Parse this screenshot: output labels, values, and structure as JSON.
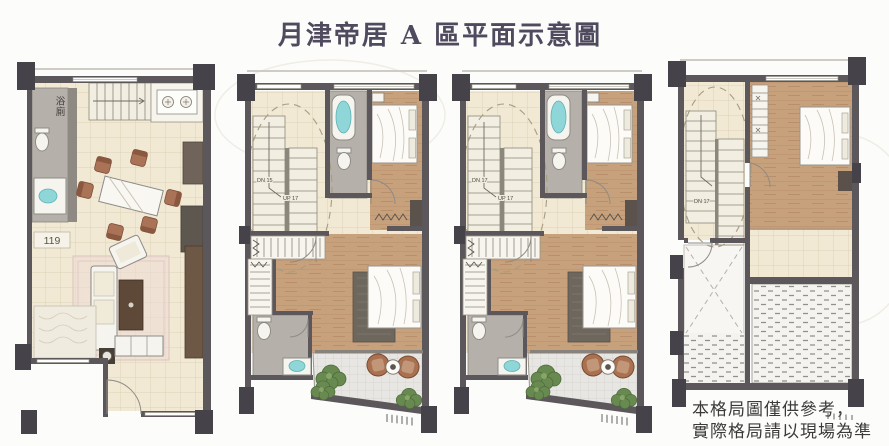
{
  "page": {
    "title": "月津帝居 A 區平面示意圖",
    "disclaimer": {
      "line1": "本格局圖僅供參考，",
      "line2": "實際格局請以現場為準"
    }
  },
  "plans": [
    {
      "id": "1f",
      "labels": {
        "bath": "浴廁",
        "unit_number": "119",
        "up": "UP"
      }
    },
    {
      "id": "2f",
      "labels": {
        "down": "DN 15",
        "up": "UP 17"
      }
    },
    {
      "id": "3f",
      "labels": {
        "down": "DN 17",
        "up": "UP 17"
      }
    },
    {
      "id": "4f",
      "labels": {
        "down": "DN 17"
      }
    }
  ],
  "colors": {
    "wall": "#5b575b",
    "column": "#454349",
    "tile_floor": "#f1e9d4",
    "wood_floor": "#c7a07c",
    "bath_floor": "#b6b0aa",
    "paving": "#e7e6e2",
    "fixture_cyan": "#8ed6d8",
    "plant_green": "#688a50",
    "chair_brown": "#a9714f",
    "rug_pink": "#eddad4",
    "title_ink": "#4f4a5e"
  }
}
